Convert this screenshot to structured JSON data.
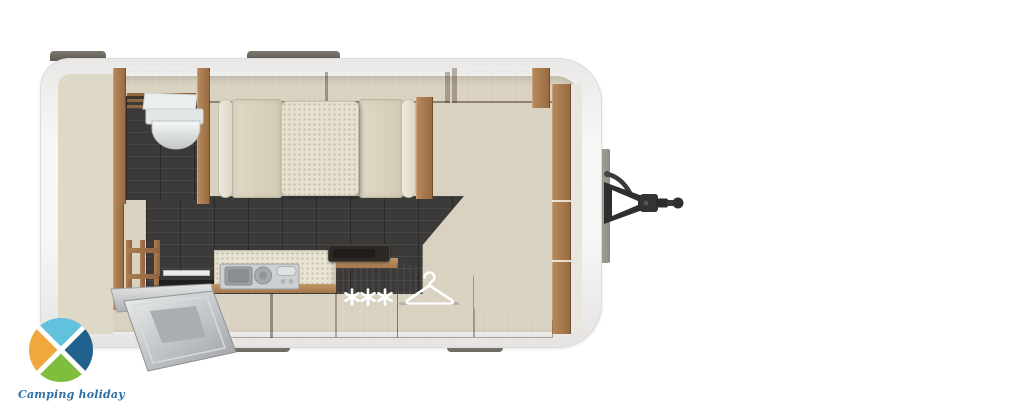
{
  "brand": {
    "logo_text": "Camping holiday",
    "logo_text_color": "#2f6fa3",
    "logo_wedge_colors": {
      "top": "#62c1dc",
      "right": "#20618e",
      "bottom": "#7fbe3d",
      "left": "#f0a73c"
    }
  },
  "scene": {
    "description": "Top-down floor plan render of a single-axle caravan travel trailer with tow hitch on the right",
    "colors": {
      "shell": "#f3f3f2",
      "wood": "#a87a4e",
      "cushion": "#d9d3be",
      "floor_dark_tiles": "#3b3a38",
      "floor_light": "#d9d2c0",
      "hitch": "#2f2f2f"
    },
    "icons": {
      "wardrobe": "clothes-hanger-icon",
      "freezer_compartment": "three-asterisks-icon",
      "bathroom": "toilet-shape",
      "kitchen": "sink-and-hob-shapes"
    }
  }
}
